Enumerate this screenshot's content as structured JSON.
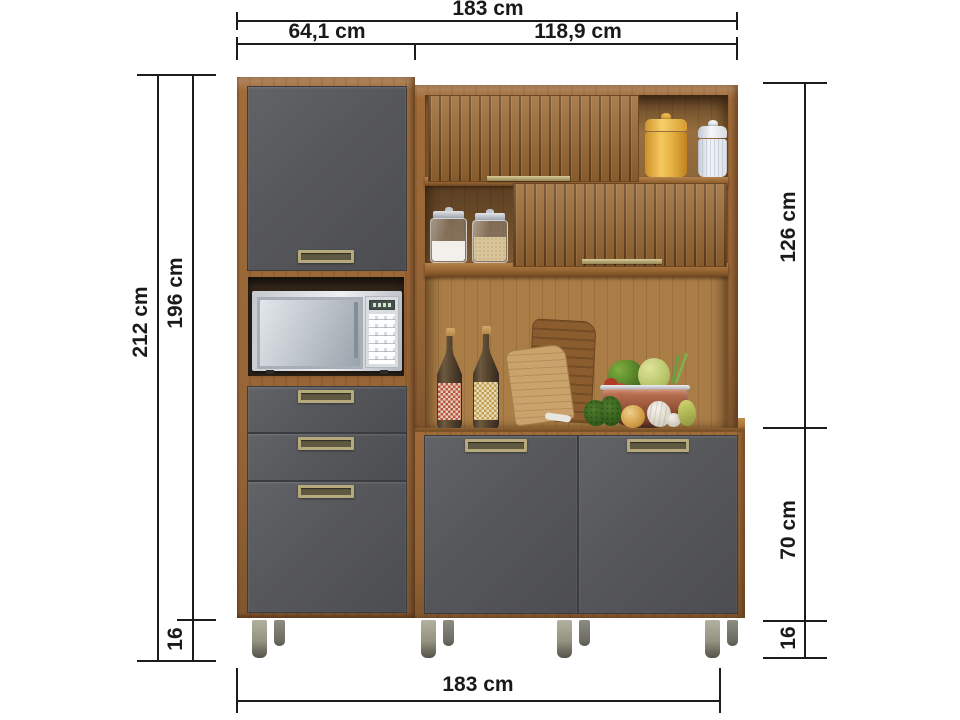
{
  "diagram": {
    "type": "furniture-dimension-diagram",
    "product": "kitchen-cabinet-with-microwave-niche"
  },
  "dimensions": {
    "top": {
      "total": "183 cm",
      "left_section": "64,1 cm",
      "right_section": "118,9 cm"
    },
    "left": {
      "total_height": "212 cm",
      "body_height": "196 cm",
      "feet_height": "16"
    },
    "right": {
      "upper_height": "126 cm",
      "lower_height": "70 cm",
      "feet_height": "16"
    },
    "bottom": {
      "total": "183 cm"
    }
  },
  "colors": {
    "background": "#ffffff",
    "dimension_lines": "#1c1c1c",
    "wood_frame": "#a06b39",
    "interior_wood": "#aa7d47",
    "door_gray": "#57585b",
    "handle_brass": "#b6aa7c",
    "leg_metal": "#9a9889",
    "canister_yellow": "#eebf55",
    "canister_white": "#e9ecf1"
  },
  "decor_items": [
    "microwave",
    "yellow-canister",
    "white-canister",
    "glass-jar-sugar",
    "glass-jar-grains",
    "bottle-red-label",
    "bottle-tan-label",
    "cutting-board-dark",
    "cutting-board-light",
    "fruit-bowl",
    "parsley",
    "onion",
    "garlic",
    "pear"
  ]
}
